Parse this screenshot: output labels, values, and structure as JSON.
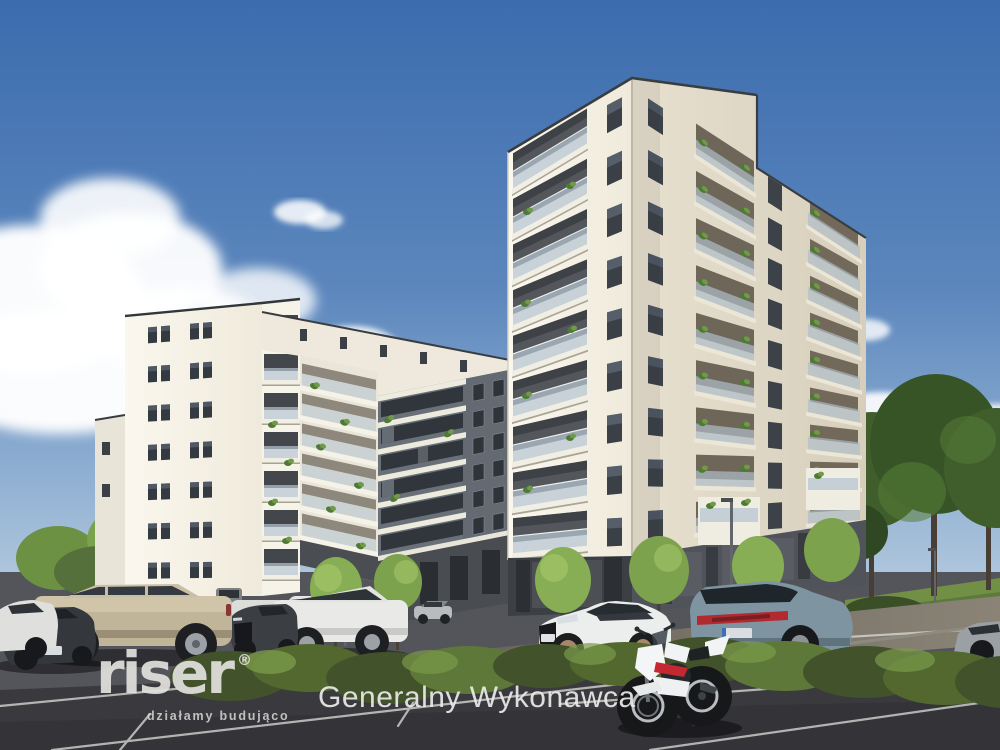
{
  "scene": {
    "type": "architectural-exterior-rendering",
    "subject": "Modern white multi-storey apartment complex with parking lot, cars, motorcycle and trees under a blue sky",
    "palette": {
      "sky_top": "#3c6cae",
      "sky_horizon": "#c4d5e3",
      "facade_white": "#f4f1e7",
      "facade_gray": "#6a7077",
      "base_dark": "#43464b",
      "asphalt": "#46464a",
      "foliage": "#4e6b33",
      "taillight_red": "#b02a30"
    }
  },
  "branding": {
    "logo_text": "riser",
    "registered_mark": "®",
    "tagline": "działamy budująco"
  },
  "caption": {
    "text": "Generalny Wykonawca"
  }
}
